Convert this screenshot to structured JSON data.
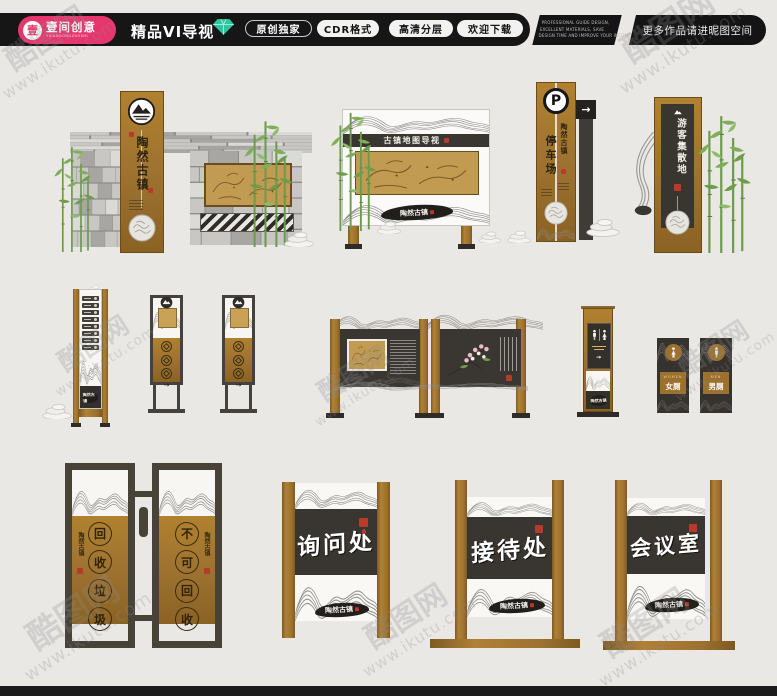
{
  "watermark": {
    "site": "酷图网",
    "url": "www.ikutu.com"
  },
  "header": {
    "logo_seal": "壹",
    "logo_title": "壹间创意",
    "logo_sub": "YIJIANGONGZUOSHI",
    "title": "精品VI导视",
    "badges": [
      {
        "label": "原创独家"
      },
      {
        "label": "CDR格式"
      },
      {
        "label": "高清分层"
      },
      {
        "label": "欢迎下载"
      }
    ],
    "tagline1": "PROFESSIONAL GUIDE DESIGN,",
    "tagline2": "EXCELLENT MATERIALS, SAVE",
    "tagline3": "DESIGN TIME AND IMPROVE YOUR INCOME",
    "more": "更多作品请进昵图空间"
  },
  "brand": {
    "name": "陶然古镇"
  },
  "glyphs": {
    "arrow_right": "→"
  },
  "signs": {
    "map_board_header": "古镇地图导视",
    "parking_p": "P",
    "parking_name": "停车场",
    "tourist_name": "游客集散地",
    "women_en": "WOMEN",
    "women_cn": "女厕",
    "men_en": "MEN",
    "men_cn": "男厕",
    "trash_left": [
      "回",
      "收",
      "垃",
      "圾"
    ],
    "trash_right": [
      "不",
      "可",
      "回",
      "收"
    ],
    "inquiry": "询问处",
    "reception": "接待处",
    "meeting": "会议室"
  }
}
